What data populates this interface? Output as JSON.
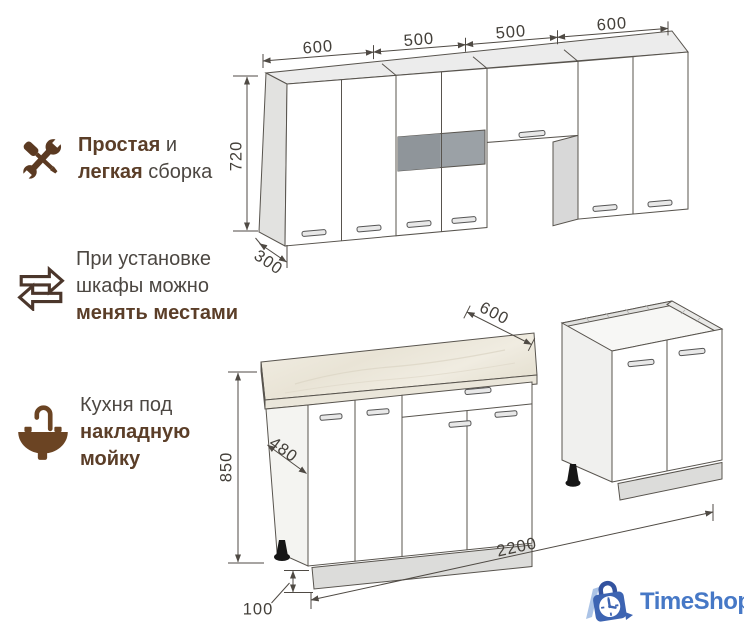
{
  "features": [
    {
      "icon": "tools-icon",
      "lines": [
        [
          {
            "t": "Простая",
            "b": true
          },
          {
            "t": " и",
            "b": false
          }
        ],
        [
          {
            "t": "легкая",
            "b": true
          },
          {
            "t": " сборка",
            "b": false
          }
        ]
      ]
    },
    {
      "icon": "swap-arrows-icon",
      "lines": [
        [
          {
            "t": "При установке",
            "b": false
          }
        ],
        [
          {
            "t": "шкафы можно",
            "b": false
          }
        ],
        [
          {
            "t": "менять местами",
            "b": true
          }
        ]
      ]
    },
    {
      "icon": "sink-icon",
      "lines": [
        [
          {
            "t": "Кухня под",
            "b": false
          }
        ],
        [
          {
            "t": "накладную",
            "b": true
          }
        ],
        [
          {
            "t": "мойку",
            "b": true
          }
        ]
      ]
    }
  ],
  "dimensions": {
    "upper_widths": [
      "600",
      "500",
      "500",
      "600"
    ],
    "upper_height": "720",
    "upper_depth": "300",
    "countertop_depth": "600",
    "base_side_depth": "480",
    "base_height": "850",
    "plinth_height": "100",
    "total_length": "2200"
  },
  "logo": {
    "icon": "clock-bag-icon",
    "text": "TimeShop"
  },
  "colors": {
    "accent_brown": "#5b3e28",
    "text": "#4c4742",
    "dimension": "#44403a",
    "logo_blue": "#4678c6",
    "glass_gray": "#9ba1a6"
  }
}
